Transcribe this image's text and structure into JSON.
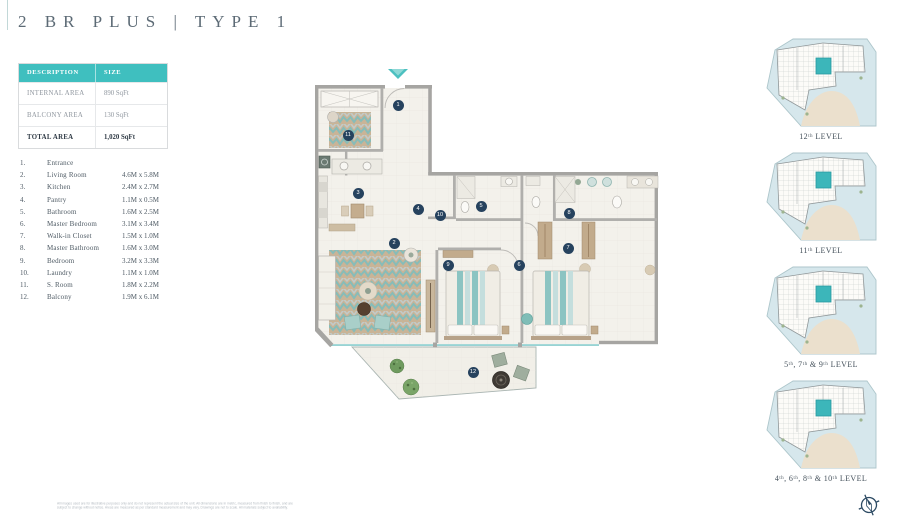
{
  "page": {
    "title": "2 BR PLUS | TYPE 1"
  },
  "area_table": {
    "headers": [
      "DESCRIPTION",
      "SIZE"
    ],
    "rows": [
      {
        "label": "INTERNAL AREA",
        "value": "890 SqFt"
      },
      {
        "label": "BALCONY AREA",
        "value": "130 SqFt"
      },
      {
        "label": "TOTAL AREA",
        "value": "1,020 SqFt"
      }
    ]
  },
  "legend": {
    "items": [
      {
        "num": "1",
        "name": "Entrance",
        "dims": ""
      },
      {
        "num": "2",
        "name": "Living Room",
        "dims": "4.6M x 5.8M"
      },
      {
        "num": "3",
        "name": "Kitchen",
        "dims": "2.4M x 2.7M"
      },
      {
        "num": "4",
        "name": "Pantry",
        "dims": "1.1M x 0.5M"
      },
      {
        "num": "5",
        "name": "Bathroom",
        "dims": "1.6M x 2.5M"
      },
      {
        "num": "6",
        "name": "Master Bedroom",
        "dims": "3.1M x 3.4M"
      },
      {
        "num": "7",
        "name": "Walk-in Closet",
        "dims": "1.5M x 1.0M"
      },
      {
        "num": "8",
        "name": "Master Bathroom",
        "dims": "1.6M x 3.0M"
      },
      {
        "num": "9",
        "name": "Bedroom",
        "dims": "3.2M x 3.3M"
      },
      {
        "num": "10",
        "name": "Laundry",
        "dims": "1.1M x 1.0M"
      },
      {
        "num": "11",
        "name": "S. Room",
        "dims": "1.8M x 2.2M"
      },
      {
        "num": "12",
        "name": "Balcony",
        "dims": "1.9M x 6.1M"
      }
    ]
  },
  "levels": [
    {
      "label": "12ᵗʰ LEVEL"
    },
    {
      "label": "11ᵗʰ LEVEL"
    },
    {
      "label": "5ᵗʰ, 7ᵗʰ & 9ᵗʰ LEVEL"
    },
    {
      "label": "4ᵗʰ, 6ᵗʰ, 8ᵗʰ & 10ᵗʰ LEVEL"
    }
  ],
  "footer": {
    "disclaimer_line1": "All images used are for illustrative purposes only and do not represent the actual size of the unit. All dimensions are in metric, measured from finish to finish, and are",
    "disclaimer_line2": "subject to change without notice. Areas are measured as per standard measurement and may vary. Drawings are not to scale. All materials subject to availability."
  },
  "icons": {
    "entrance_arrow": "entrance-arrow-icon",
    "compass": "compass-north-icon"
  },
  "colors": {
    "teal_accent": "#3fbfbf",
    "badge_navy": "#26425e",
    "wall_gray": "#a6a5a2",
    "water_blue": "#d6e7ec",
    "unit_highlight": "#3cb6ba"
  }
}
